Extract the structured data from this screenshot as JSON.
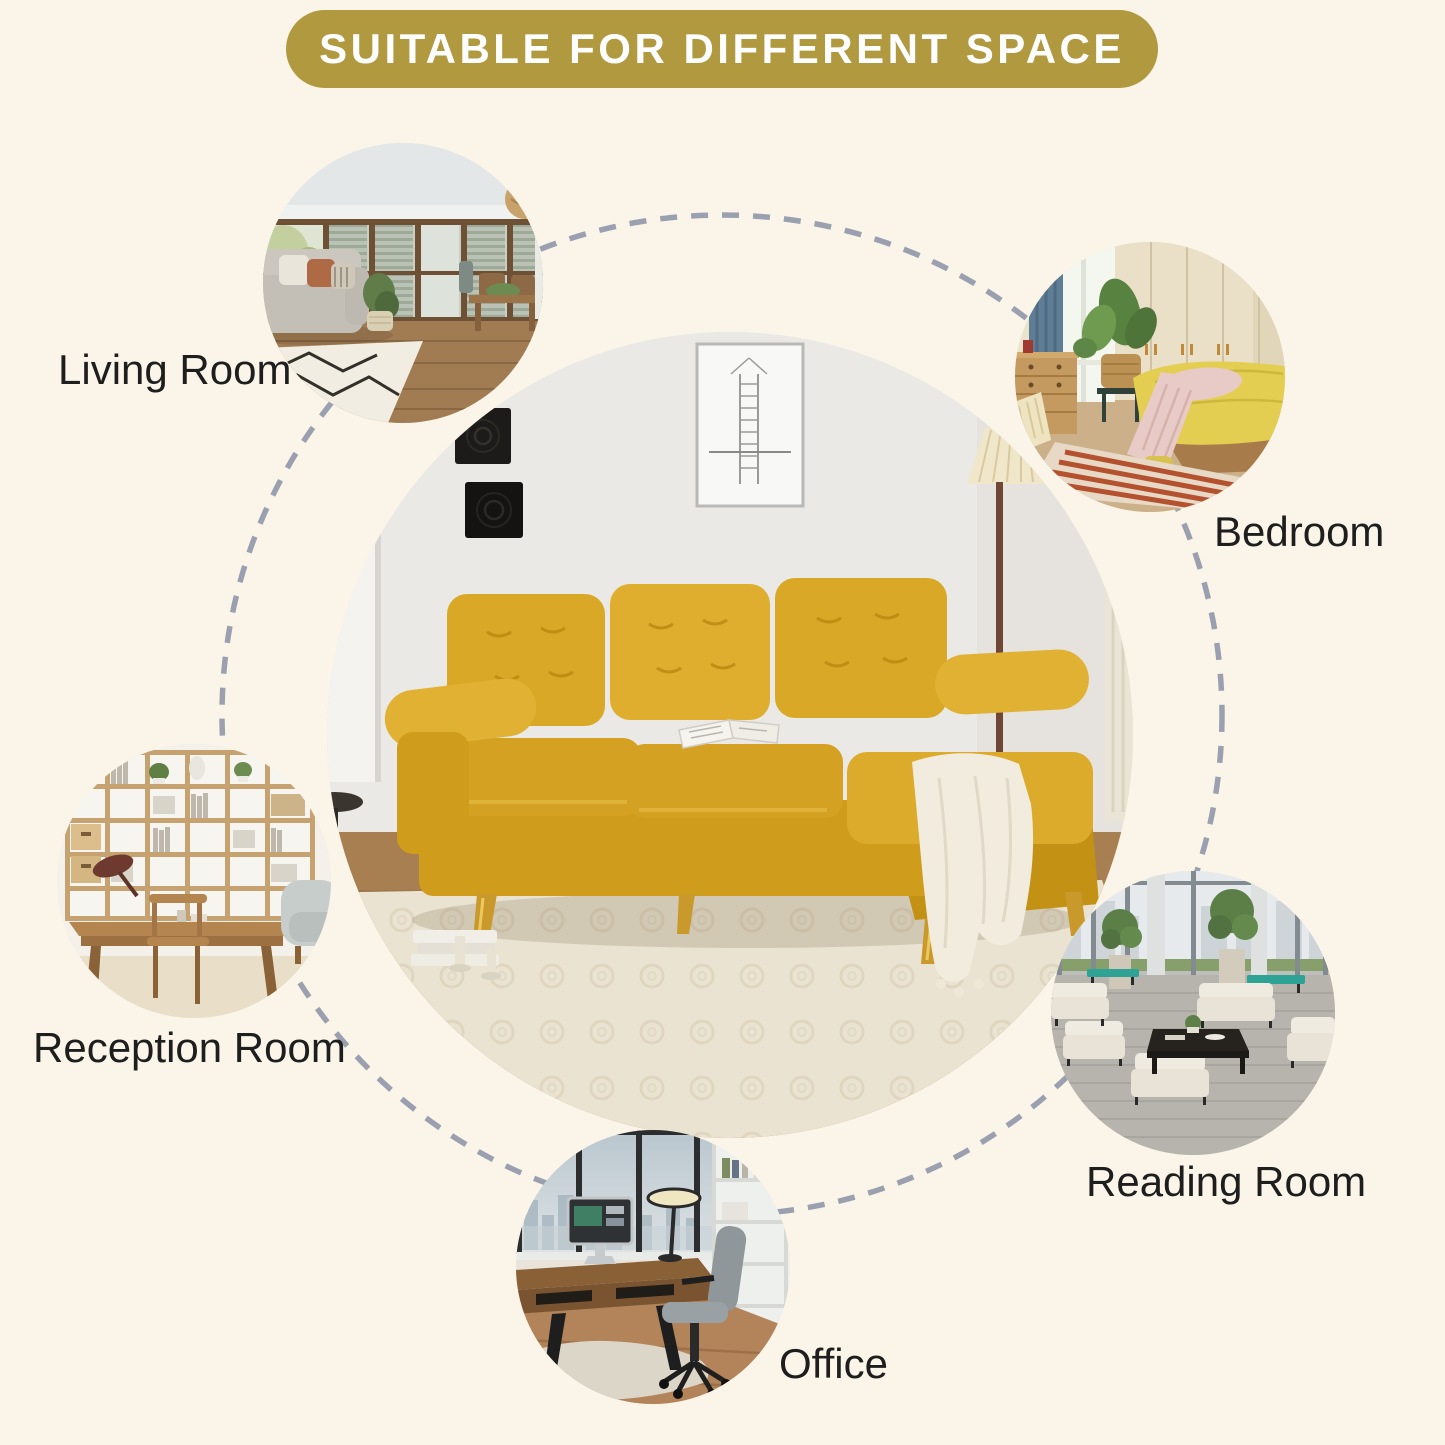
{
  "banner": {
    "label": "SUITABLE FOR DIFFERENT SPACE"
  },
  "rooms": [
    {
      "id": "living-room",
      "label": "Living Room"
    },
    {
      "id": "bedroom",
      "label": "Bedroom"
    },
    {
      "id": "reception-room",
      "label": "Reception Room"
    },
    {
      "id": "reading-room",
      "label": "Reading Room"
    },
    {
      "id": "office",
      "label": "Office"
    }
  ],
  "center_photo": {
    "description": "Yellow sectional sofa with chaise, gold metal legs, white throw blanket, in a bright living room"
  },
  "colors": {
    "background": "#faf5e8",
    "banner_bg": "#b1993f",
    "banner_text": "#ffffff",
    "label_text": "#1e1e1e",
    "dash": "#9aa0af",
    "sofa_accent": "#d9a827"
  }
}
